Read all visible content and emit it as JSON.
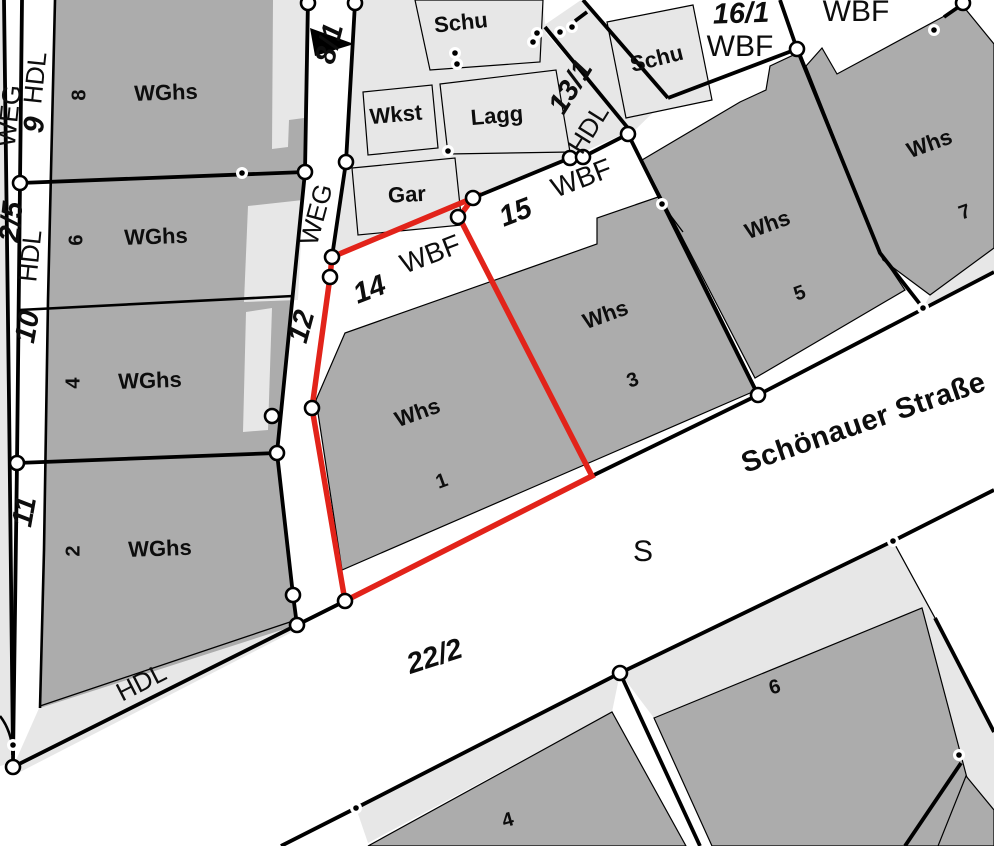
{
  "map": {
    "kind": "cadastral-parcel-map",
    "selected_parcel": {
      "number": "14",
      "usage": "WBF",
      "building_label": "Whs",
      "building_number": "1"
    },
    "street_name": "Schönauer Straße"
  },
  "colors": {
    "background": "#ffffff",
    "open_area": "#e7e7e7",
    "building": "#acacac",
    "line": "#000000",
    "selection_red": "#e2231a",
    "vertex_fill": "#ffffff"
  },
  "labels": [
    {
      "id": "weg-left",
      "text": "WEG",
      "x": 11,
      "y": 116,
      "rot": -84,
      "cls": "road"
    },
    {
      "id": "hdl-left-top",
      "text": "HDL",
      "x": 37,
      "y": 78,
      "rot": -84,
      "cls": "road"
    },
    {
      "id": "num-9",
      "text": "9",
      "x": 36,
      "y": 125,
      "rot": -84,
      "cls": "num"
    },
    {
      "id": "num-2-5",
      "text": "2/5",
      "x": 13,
      "y": 222,
      "rot": -84,
      "cls": "num"
    },
    {
      "id": "hdl-left-mid",
      "text": "HDL",
      "x": 32,
      "y": 256,
      "rot": -84,
      "cls": "road"
    },
    {
      "id": "num-10",
      "text": "10",
      "x": 29,
      "y": 327,
      "rot": -80,
      "cls": "num"
    },
    {
      "id": "num-11",
      "text": "11",
      "x": 26,
      "y": 512,
      "rot": -80,
      "cls": "num"
    },
    {
      "id": "wghs-8",
      "text": "WGhs",
      "x": 166,
      "y": 94,
      "rot": -2,
      "cls": "bld"
    },
    {
      "id": "num-8",
      "text": "8",
      "x": 80,
      "y": 95,
      "rot": -90,
      "cls": "bldnum"
    },
    {
      "id": "wghs-6",
      "text": "WGhs",
      "x": 156,
      "y": 238,
      "rot": -2,
      "cls": "bld"
    },
    {
      "id": "num-6",
      "text": "6",
      "x": 77,
      "y": 240,
      "rot": -90,
      "cls": "bldnum"
    },
    {
      "id": "wghs-4",
      "text": "WGhs",
      "x": 150,
      "y": 382,
      "rot": -2,
      "cls": "bld"
    },
    {
      "id": "num-4",
      "text": "4",
      "x": 74,
      "y": 383,
      "rot": -90,
      "cls": "bldnum"
    },
    {
      "id": "wghs-2",
      "text": "WGhs",
      "x": 160,
      "y": 550,
      "rot": -2,
      "cls": "bld"
    },
    {
      "id": "num-2",
      "text": "2",
      "x": 74,
      "y": 551,
      "rot": -90,
      "cls": "bldnum"
    },
    {
      "id": "weg-path",
      "text": "WEG",
      "x": 318,
      "y": 215,
      "rot": -75,
      "cls": "road"
    },
    {
      "id": "num-12",
      "text": "12",
      "x": 303,
      "y": 327,
      "rot": -75,
      "cls": "num"
    },
    {
      "id": "num-8-1",
      "text": "8/1",
      "x": 331,
      "y": 44,
      "rot": -76,
      "cls": "num"
    },
    {
      "id": "schu-top",
      "text": "Schu",
      "x": 461,
      "y": 24,
      "rot": -6,
      "cls": "bld"
    },
    {
      "id": "wkst",
      "text": "Wkst",
      "x": 396,
      "y": 116,
      "rot": -5,
      "cls": "bld"
    },
    {
      "id": "lagg",
      "text": "Lagg",
      "x": 497,
      "y": 117,
      "rot": -5,
      "cls": "bld"
    },
    {
      "id": "gar",
      "text": "Gar",
      "x": 407,
      "y": 196,
      "rot": -3,
      "cls": "bld"
    },
    {
      "id": "num-13-1",
      "text": "13/1",
      "x": 572,
      "y": 88,
      "rot": -58,
      "cls": "num"
    },
    {
      "id": "hdl-13-1",
      "text": "HDL",
      "x": 590,
      "y": 130,
      "rot": -58,
      "cls": "road"
    },
    {
      "id": "schu-right",
      "text": "Schu",
      "x": 657,
      "y": 60,
      "rot": -14,
      "cls": "bld"
    },
    {
      "id": "num-16-1",
      "text": "16/1",
      "x": 741,
      "y": 15,
      "rot": -2,
      "cls": "num"
    },
    {
      "id": "wbf-16-1",
      "text": "WBF",
      "x": 740,
      "y": 48,
      "rot": 0,
      "cls": "road30"
    },
    {
      "id": "wbf-top-right",
      "text": "WBF",
      "x": 856,
      "y": 13,
      "rot": 0,
      "cls": "road30"
    },
    {
      "id": "num-15",
      "text": "15",
      "x": 516,
      "y": 214,
      "rot": -21,
      "cls": "num"
    },
    {
      "id": "wbf-15",
      "text": "WBF",
      "x": 582,
      "y": 180,
      "rot": -21,
      "cls": "road28"
    },
    {
      "id": "num-14",
      "text": "14",
      "x": 370,
      "y": 291,
      "rot": -21,
      "cls": "num"
    },
    {
      "id": "wbf-14",
      "text": "WBF",
      "x": 431,
      "y": 256,
      "rot": -21,
      "cls": "road28"
    },
    {
      "id": "whs-1",
      "text": "Whs",
      "x": 418,
      "y": 414,
      "rot": -20,
      "cls": "bld"
    },
    {
      "id": "num-1",
      "text": "1",
      "x": 442,
      "y": 482,
      "rot": -20,
      "cls": "bldnum"
    },
    {
      "id": "whs-3",
      "text": "Whs",
      "x": 606,
      "y": 316,
      "rot": -20,
      "cls": "bld"
    },
    {
      "id": "num-3",
      "text": "3",
      "x": 633,
      "y": 381,
      "rot": -20,
      "cls": "bldnum"
    },
    {
      "id": "whs-5",
      "text": "Whs",
      "x": 768,
      "y": 226,
      "rot": -20,
      "cls": "bld"
    },
    {
      "id": "num-5",
      "text": "5",
      "x": 800,
      "y": 294,
      "rot": -20,
      "cls": "bldnum"
    },
    {
      "id": "whs-7",
      "text": "Whs",
      "x": 930,
      "y": 145,
      "rot": -20,
      "cls": "bld"
    },
    {
      "id": "num-7",
      "text": "7",
      "x": 965,
      "y": 213,
      "rot": -20,
      "cls": "bldnum"
    },
    {
      "id": "hdl-bottom",
      "text": "HDL",
      "x": 142,
      "y": 684,
      "rot": -27,
      "cls": "road"
    },
    {
      "id": "num-22-2",
      "text": "22/2",
      "x": 435,
      "y": 658,
      "rot": -18,
      "cls": "num"
    },
    {
      "id": "s-street",
      "text": "S",
      "x": 643,
      "y": 553,
      "rot": 0,
      "cls": "road30"
    },
    {
      "id": "street-name",
      "text": "Schönauer Straße",
      "x": 864,
      "y": 424,
      "rot": -19,
      "cls": "street"
    },
    {
      "id": "num-6-bottom",
      "text": "6",
      "x": 775,
      "y": 688,
      "rot": -16,
      "cls": "bldnum"
    },
    {
      "id": "num-4-bottom",
      "text": "4",
      "x": 508,
      "y": 821,
      "rot": -16,
      "cls": "bldnum"
    }
  ]
}
